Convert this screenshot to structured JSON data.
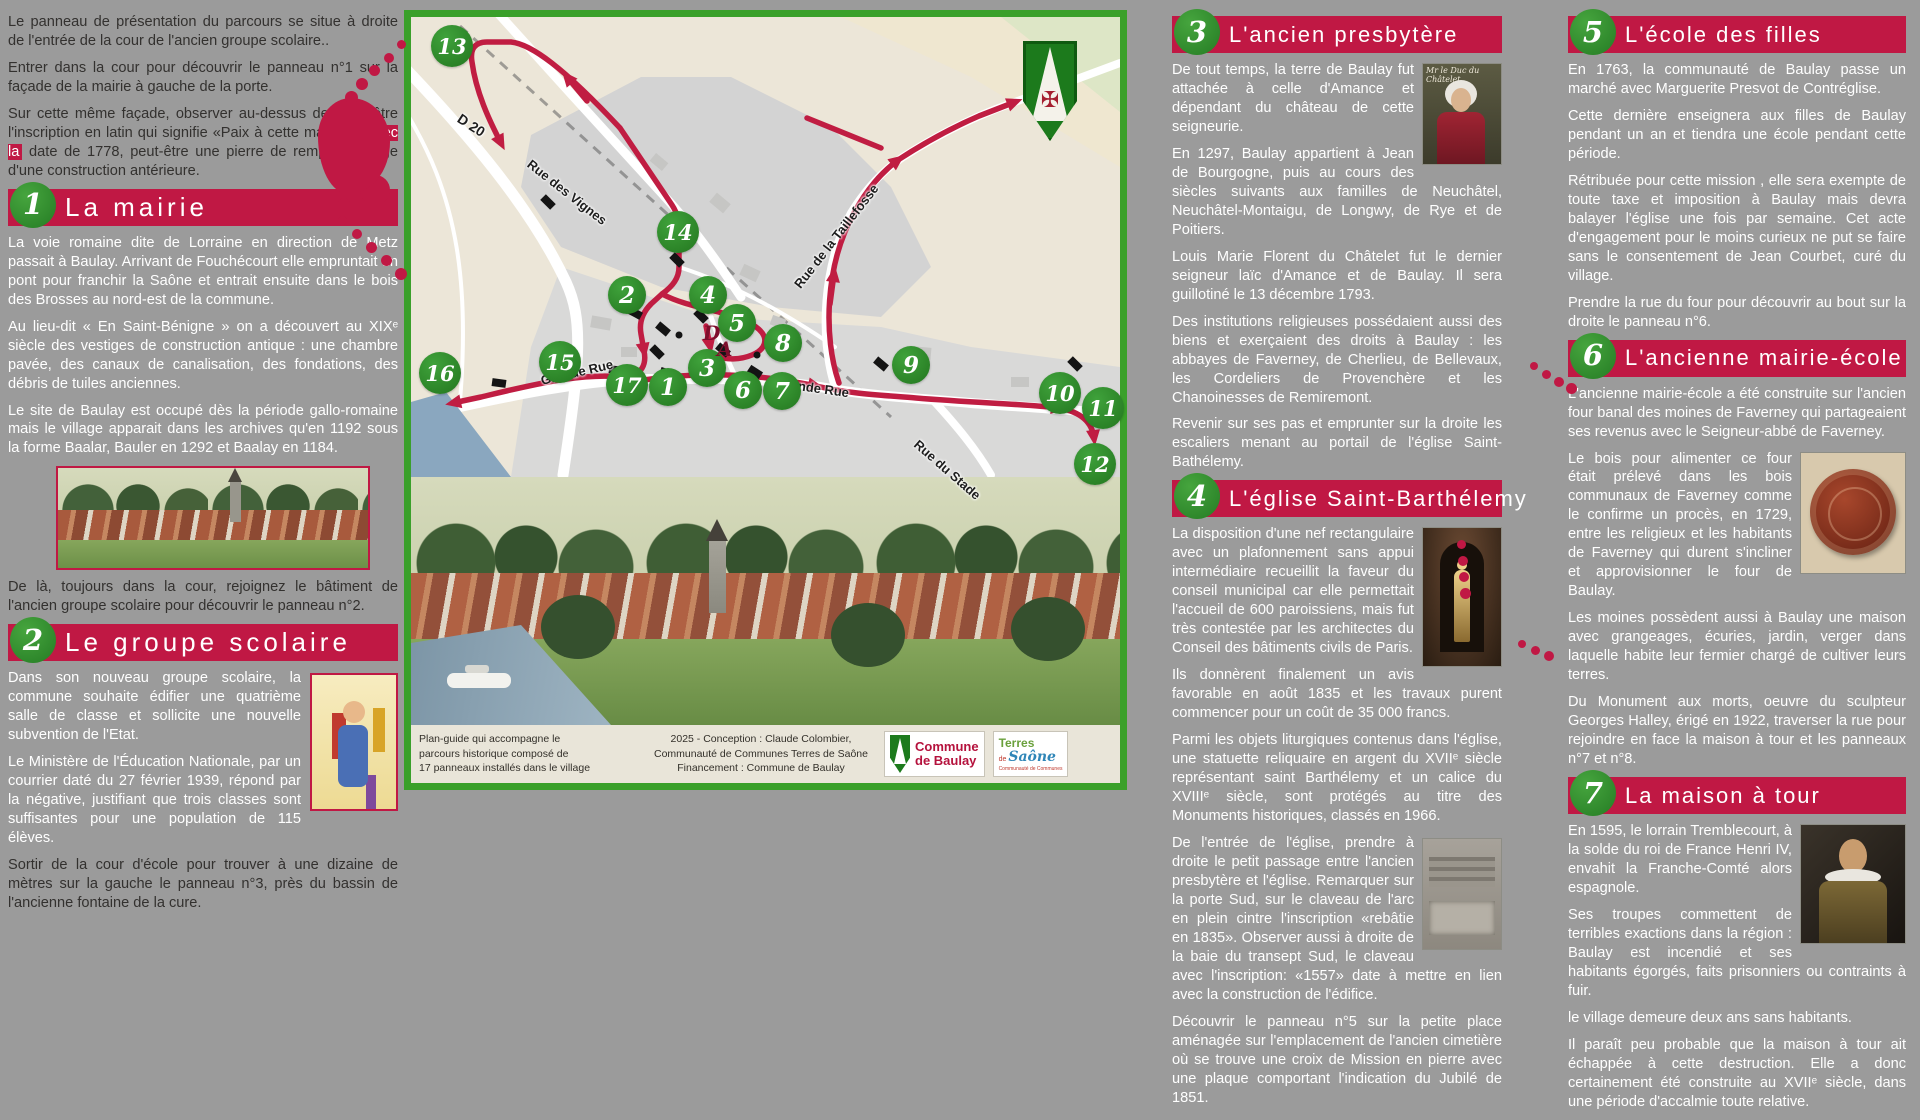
{
  "intro": {
    "p1": "Le panneau de présentation du parcours se situe à droite de l'entrée de la cour de l'ancien groupe scolaire..",
    "p2": "Entrer dans la cour pour découvrir le panneau n°1 sur la façade de la mairie à gauche de la porte.",
    "p3a": "Sur cette même façade, observer au-dessus de la fenêtre l'inscription en latin qui signifie «Paix à cette maison» ",
    "p3hl": "avec la",
    "p3b": " date de 1778, peut-être une pierre de remploi, vestige d'une construction antérieure."
  },
  "panels": {
    "p1": {
      "num": "1",
      "title": "La mairie",
      "paras": [
        "La voie romaine dite de Lorraine en direction de Metz passait à Baulay. Arrivant de Fouchécourt elle empruntait un pont pour franchir la Saône et entrait ensuite dans le bois des Brosses au nord-est de la commune.",
        "Au lieu-dit « En Saint-Bénigne »  on a découvert au XIXᵉ siècle des vestiges de construction antique : une chambre pavée, des canaux de canalisation, des fondations, des débris de tuiles anciennes.",
        "Le site de Baulay est occupé dès la période gallo-romaine mais le village apparait dans les archives qu'en 1192 sous la forme Baalar, Bauler en 1292 et Baalay en 1184."
      ],
      "direction": "De là, toujours dans la cour, rejoignez le bâtiment de l'ancien groupe scolaire pour découvrir le panneau n°2."
    },
    "p2": {
      "num": "2",
      "title": "Le groupe scolaire",
      "paras": [
        "Dans son nouveau groupe scolaire, la commune souhaite édifier une quatrième salle de classe et sollicite une nouvelle subvention de l'Etat.",
        "Le Ministère de l'Éducation Nationale, par un courrier daté du 27 février 1939, répond par la négative, justifiant que trois classes sont suffisantes pour une population de 115 élèves."
      ],
      "direction": "Sortir de la cour d'école pour trouver à une dizaine de mètres sur la gauche le panneau n°3, près du bassin de l'ancienne fontaine de la cure."
    },
    "p3": {
      "num": "3",
      "title": "L'ancien presbytère",
      "img_caption": "Mr le Duc du Châtelet",
      "paras": [
        "De tout temps, la terre de Baulay fut attachée à celle d'Amance et dépendant du château de cette seigneurie.",
        "En 1297, Baulay appartient à Jean de Bourgogne, puis au cours des siècles suivants aux familles de Neuchâtel, Neuchâtel-Montaigu, de Longwy, de Rye et de Poitiers.",
        "Louis Marie Florent du Châtelet fut le dernier seigneur laïc d'Amance et de Baulay. Il sera guillotiné le 13 décembre 1793.",
        "Des institutions religieuses possédaient aussi des biens et exerçaient des droits à Baulay : les abbayes de Faverney, de Cherlieu, de Bellevaux, les Cordeliers de Provenchère et  les Chanoinesses de Remiremont.",
        "Revenir sur ses pas et emprunter sur la droite les escaliers menant au portail de l'église Saint-Bathélemy."
      ]
    },
    "p4": {
      "num": "4",
      "title": "L'église Saint-Barthélemy",
      "paras": [
        "La disposition d'une nef rectangulaire avec un plafonnement sans appui intermédiaire recueillit la faveur du conseil municipal car elle permettait l'accueil de 600 paroissiens, mais fut très contestée par les architectes du Conseil des bâtiments civils de Paris.",
        "Ils donnèrent finalement un avis favorable en août 1835 et les travaux purent commencer pour un coût de 35 000 francs.",
        "Parmi les objets liturgiques contenus dans l'église, une statuette reliquaire en argent du XVIIᵉ siècle représentant saint Barthélemy et un calice du XVIIIᵉ siècle, sont protégés au titre des Monuments historiques, classés en 1966.",
        "De l'entrée de l'église, prendre à droite le petit passage entre l'ancien presbytère et l'église. Remarquer sur la porte Sud, sur le claveau de l'arc en plein cintre l'inscription «rebâtie en 1835». Observer aussi à droite de la baie du transept Sud, le claveau avec l'inscription: «1557» date à mettre en lien avec la construction de l'édifice.",
        "Découvrir le panneau n°5 sur la petite place aménagée sur l'emplacement de l'ancien cimetière où se trouve une croix de Mission en pierre avec une plaque comportant l'indication du Jubilé de 1851."
      ]
    },
    "p5": {
      "num": "5",
      "title": "L'école des filles",
      "paras": [
        "En 1763, la communauté de Baulay passe un marché avec Marguerite Presvot de Contréglise.",
        "Cette dernière enseignera aux filles de Baulay pendant un an et tiendra une école pendant cette période.",
        "Rétribuée pour cette mission , elle sera exempte de toute taxe et imposition à Baulay mais devra balayer l'église une fois par semaine. Cet acte d'engagement pour le moins curieux ne put se faire sans le consentement de Jean Courbet, curé du village.",
        "Prendre la rue du four pour découvrir au bout sur la droite le panneau n°6."
      ]
    },
    "p6": {
      "num": "6",
      "title": "L'ancienne mairie-école",
      "paras": [
        "L'ancienne mairie-école a été construite sur l'ancien four banal des moines de Faverney qui partageaient ses revenus avec le Seigneur-abbé de Faverney.",
        "Le bois pour alimenter ce four était prélevé dans les bois communaux de Faverney comme le confirme un procès, en 1729, entre les religieux et les habitants de Faverney qui durent s'incliner et approvisionner le four de Baulay.",
        "Les moines possèdent aussi à Baulay une maison avec grangeages, écuries, jardin, verger dans laquelle habite leur fermier chargé de cultiver leurs terres.",
        "Du Monument aux morts, oeuvre du sculpteur Georges Halley, érigé en 1922, traverser la rue pour rejoindre en face la maison à tour et les panneaux n°7 et n°8."
      ]
    },
    "p7": {
      "num": "7",
      "title": "La maison à tour",
      "paras": [
        "En 1595, le lorrain Tremblecourt, à la solde du roi de France Henri IV, envahit la Franche-Comté alors espagnole.",
        "Ses troupes commettent de terribles exactions dans la région : Baulay est incendié et ses habitants égorgés, faits prisonniers ou contraints à fuir.",
        "le village demeure deux ans sans habitants.",
        "Il paraît peu probable que la maison à tour ait échappée à cette destruction. Elle a donc certainement été construite au XVIIᵉ siècle, dans une période d'accalmie toute relative."
      ]
    }
  },
  "map": {
    "markers": [
      "1",
      "2",
      "3",
      "4",
      "5",
      "6",
      "7",
      "8",
      "9",
      "10",
      "11",
      "12",
      "13",
      "14",
      "15",
      "16",
      "17"
    ],
    "depart": "D",
    "arrivee": "A",
    "labels": {
      "d20": "D 20",
      "vignes": "Rue des Vignes",
      "taillefosse": "Rue de la Taillefosse",
      "grande1": "Grande Rue",
      "grande2": "Grande Rue",
      "stade": "Rue du Stade"
    },
    "route_color": "#c01d42",
    "marker_color": "#2e8d2c"
  },
  "caption": {
    "left": [
      "Plan-guide qui accompagne le",
      "parcours historique composé de",
      "17 panneaux installés dans le village"
    ],
    "credit": [
      "2025 - Conception : Claude Colombier,",
      "Communauté de Communes Terres de Saône",
      "Financement : Commune de Baulay"
    ]
  },
  "logos": {
    "commune_l1": "Commune",
    "commune_l2": "de Baulay",
    "terres_l1": "Terres",
    "terres_de": "de",
    "terres_l2": "Saône",
    "terres_sub": "Communauté de Communes"
  }
}
